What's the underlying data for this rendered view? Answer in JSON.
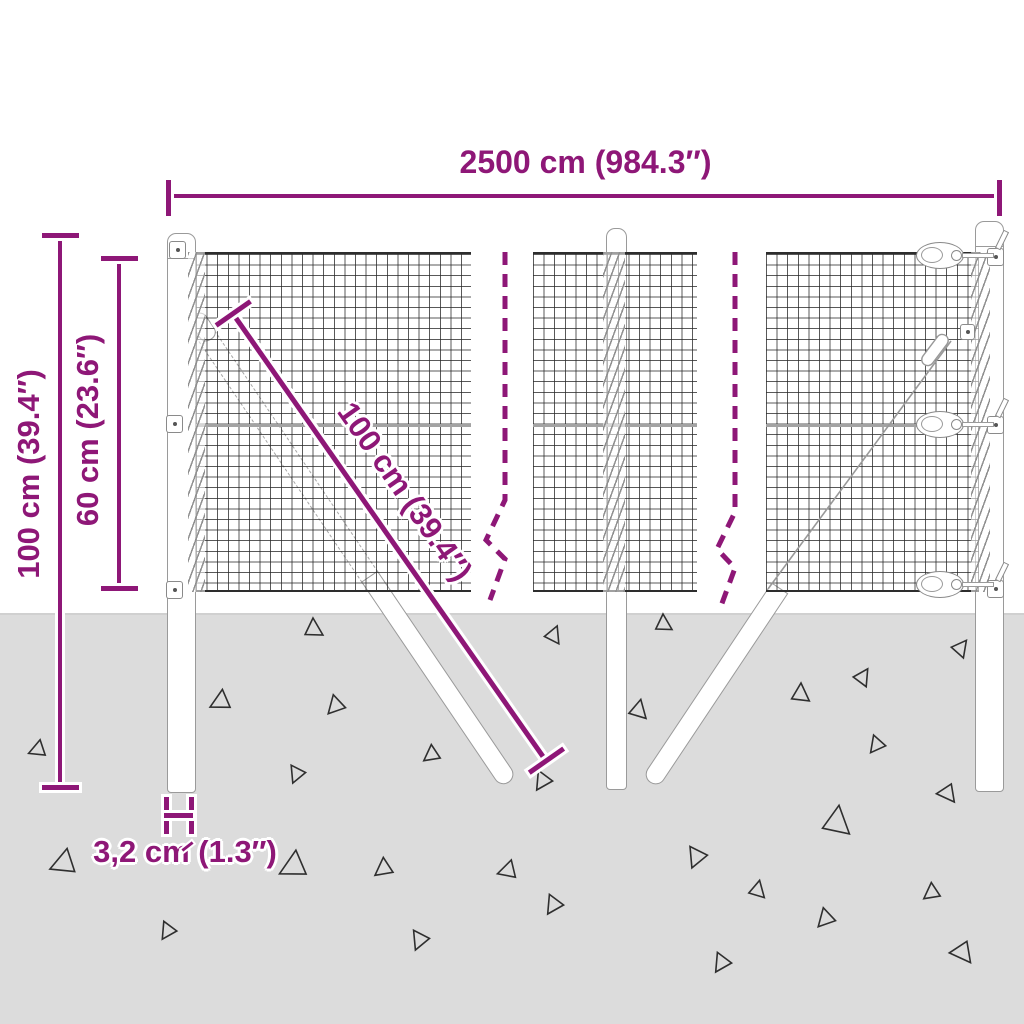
{
  "diagram": {
    "title": "wire-mesh-fence-dimension-diagram",
    "dimensions": {
      "total_width": "2500 cm (984.3″)",
      "total_height": "100 cm (39.4″)",
      "mesh_height": "60 cm (23.6″)",
      "brace_length": "100 cm (39.4″)",
      "post_width": "3,2 cm (1.3″)"
    },
    "colors": {
      "accent": "#8E1777",
      "ground": "#DCDCDC",
      "mesh_line": "#2A2A2A",
      "hardware_outline": "#9A9A9A"
    },
    "ground": {
      "triangles": [
        {
          "x": 313,
          "y": 629,
          "s": 11,
          "r": 0
        },
        {
          "x": 553,
          "y": 635,
          "s": 10,
          "r": 25
        },
        {
          "x": 663,
          "y": 624,
          "s": 10,
          "r": 0
        },
        {
          "x": 638,
          "y": 710,
          "s": 11,
          "r": 15
        },
        {
          "x": 800,
          "y": 694,
          "s": 11,
          "r": 5
        },
        {
          "x": 862,
          "y": 677,
          "s": 10,
          "r": 35
        },
        {
          "x": 960,
          "y": 648,
          "s": 10,
          "r": 40
        },
        {
          "x": 221,
          "y": 702,
          "s": 12,
          "r": 245
        },
        {
          "x": 336,
          "y": 706,
          "s": 11,
          "r": 225
        },
        {
          "x": 38,
          "y": 750,
          "s": 10,
          "r": 250
        },
        {
          "x": 432,
          "y": 755,
          "s": 10,
          "r": 235
        },
        {
          "x": 297,
          "y": 774,
          "s": 10,
          "r": 205
        },
        {
          "x": 543,
          "y": 781,
          "s": 11,
          "r": 215
        },
        {
          "x": 948,
          "y": 793,
          "s": 11,
          "r": 145
        },
        {
          "x": 836,
          "y": 822,
          "s": 17,
          "r": 10
        },
        {
          "x": 64,
          "y": 864,
          "s": 15,
          "r": 250
        },
        {
          "x": 294,
          "y": 867,
          "s": 16,
          "r": 245
        },
        {
          "x": 384,
          "y": 869,
          "s": 11,
          "r": 235
        },
        {
          "x": 508,
          "y": 871,
          "s": 11,
          "r": 255
        },
        {
          "x": 554,
          "y": 905,
          "s": 11,
          "r": 215
        },
        {
          "x": 420,
          "y": 940,
          "s": 11,
          "r": 205
        },
        {
          "x": 168,
          "y": 931,
          "s": 10,
          "r": 215
        },
        {
          "x": 697,
          "y": 857,
          "s": 12,
          "r": 205
        },
        {
          "x": 757,
          "y": 890,
          "s": 10,
          "r": 15
        },
        {
          "x": 826,
          "y": 919,
          "s": 11,
          "r": 225
        },
        {
          "x": 932,
          "y": 893,
          "s": 10,
          "r": 235
        },
        {
          "x": 963,
          "y": 952,
          "s": 13,
          "r": 145
        },
        {
          "x": 722,
          "y": 963,
          "s": 11,
          "r": 215
        },
        {
          "x": 877,
          "y": 745,
          "s": 10,
          "r": 220
        }
      ]
    }
  }
}
